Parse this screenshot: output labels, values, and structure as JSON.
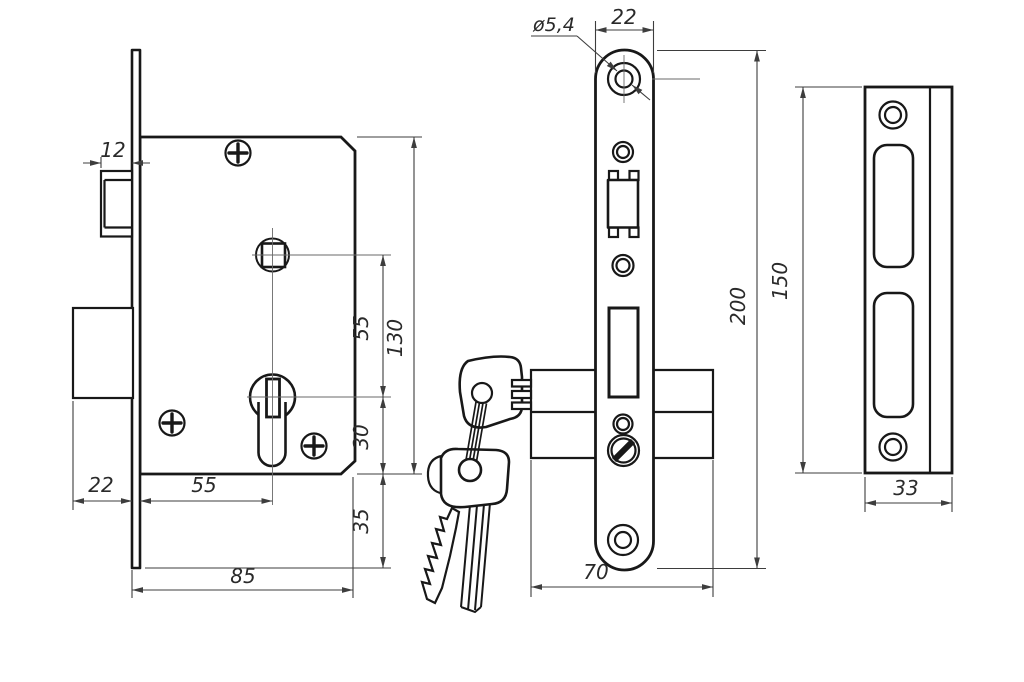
{
  "colors": {
    "outline": "#181818",
    "dimension": "#3d3d3d",
    "label": "#2a2a2a",
    "background": "#ffffff"
  },
  "views": {
    "side": {
      "dims": {
        "latch_depth": "12",
        "bolt_throw": "22",
        "backset": "55",
        "body_width": "85",
        "hub_to_cylinder": "55",
        "body_height": "130",
        "cylinder_to_edge": "30",
        "plate_overhang": "35"
      }
    },
    "front": {
      "dims": {
        "hole_diameter": "ø5,4",
        "plate_width": "22",
        "plate_height": "200",
        "body_length": "70"
      }
    },
    "strike": {
      "dims": {
        "height": "150",
        "width": "33"
      }
    }
  }
}
